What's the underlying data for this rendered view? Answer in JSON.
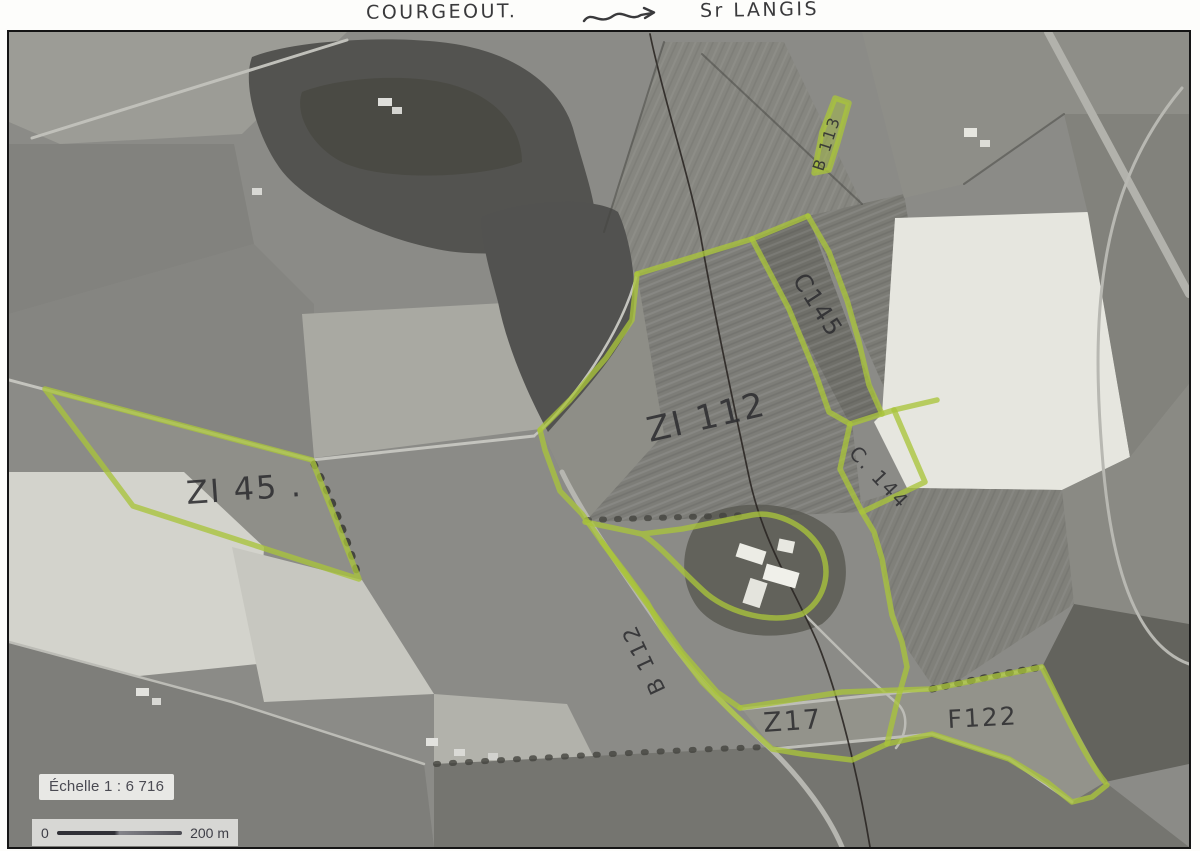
{
  "annotations": {
    "left_label": "COURGEOUT.",
    "right_label": "Sr LANGIS",
    "arrow_icon": "hand-drawn-double-arrow"
  },
  "parcels": {
    "zi45": "ZI 45 .",
    "zi112": "ZI 112",
    "c145": "C145",
    "c144": "C. 144",
    "b112": "B 112",
    "b113": "B 113",
    "z17": "Z17",
    "f122": "F122"
  },
  "scale": {
    "label": "Échelle 1 : 6 716",
    "bar_start": "0",
    "bar_end": "200 m"
  },
  "colors": {
    "highlighter": "#a9c43b",
    "pen": "#3a3a3c",
    "scale_text": "#4a4a52",
    "paper": "#fdfdfb"
  }
}
